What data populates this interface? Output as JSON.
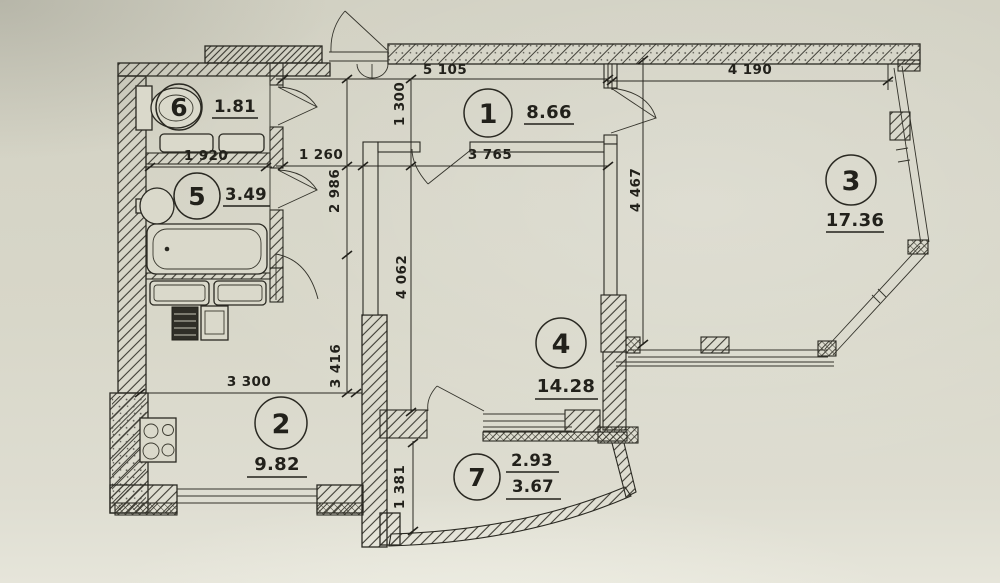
{
  "plan": {
    "rooms": {
      "r1": {
        "number": "1",
        "area": "8.66"
      },
      "r2": {
        "number": "2",
        "area": "9.82"
      },
      "r3": {
        "number": "3",
        "area": "17.36"
      },
      "r4": {
        "number": "4",
        "area": "14.28"
      },
      "r5": {
        "number": "5",
        "area": "3.49"
      },
      "r6": {
        "number": "6",
        "area": "1.81"
      },
      "r7": {
        "number": "7",
        "area_top": "2.93",
        "area_bottom": "3.67"
      }
    },
    "dimensions": {
      "d5105": "5 105",
      "d4190": "4 190",
      "d1300": "1 300",
      "d1260": "1 260",
      "d3765": "3 765",
      "d1920": "1 920",
      "d2986": "2 986",
      "d3416": "3 416",
      "d4062": "4 062",
      "d4467": "4 467",
      "d3300": "3 300",
      "d1381": "1 381"
    },
    "colors": {
      "paper": "#d8d7c9",
      "ink": "#2a2922"
    }
  }
}
